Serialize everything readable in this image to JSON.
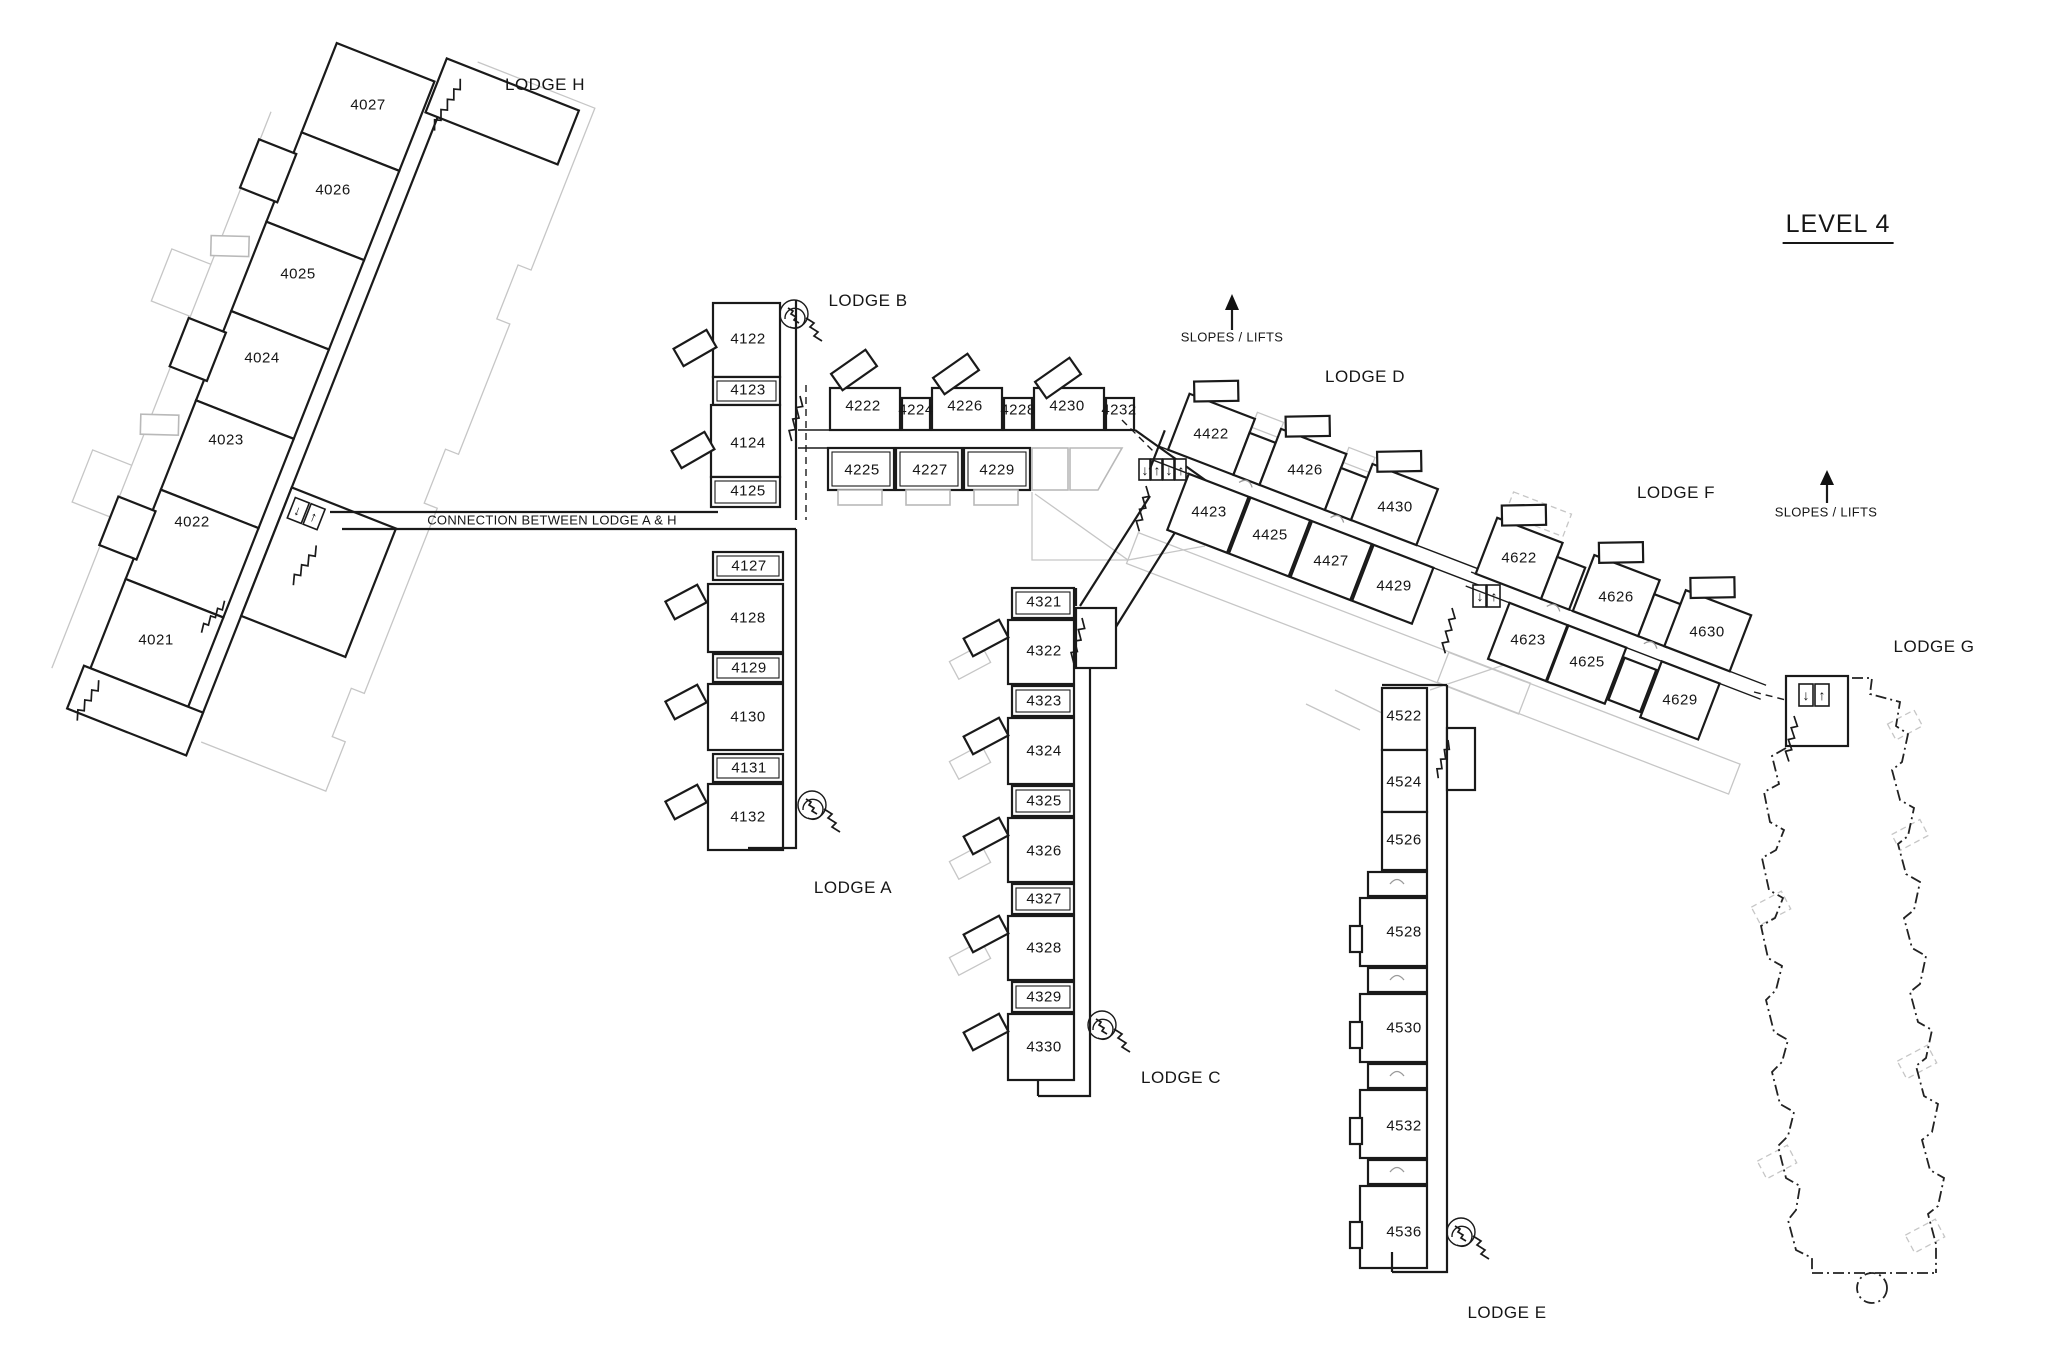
{
  "icons": {
    "elevator_down": "↓",
    "elevator_up": "↑"
  },
  "colors": {
    "wall": "#1a1a1a",
    "ghost": "#c6c6c6",
    "text": "#161616"
  },
  "place_labels": [
    {
      "id": "level-title",
      "text": "LEVEL 4",
      "x": 1838,
      "y": 227,
      "cls": "title"
    },
    {
      "id": "lodge-h-label",
      "text": "LODGE H",
      "x": 545,
      "y": 85,
      "cls": "lodge"
    },
    {
      "id": "lodge-b-label",
      "text": "LODGE B",
      "x": 868,
      "y": 301,
      "cls": "lodge"
    },
    {
      "id": "lodge-a-label",
      "text": "LODGE A",
      "x": 853,
      "y": 888,
      "cls": "lodge"
    },
    {
      "id": "lodge-c-label",
      "text": "LODGE C",
      "x": 1181,
      "y": 1078,
      "cls": "lodge"
    },
    {
      "id": "lodge-d-label",
      "text": "LODGE D",
      "x": 1365,
      "y": 377,
      "cls": "lodge"
    },
    {
      "id": "lodge-e-label",
      "text": "LODGE E",
      "x": 1507,
      "y": 1313,
      "cls": "lodge"
    },
    {
      "id": "lodge-f-label",
      "text": "LODGE F",
      "x": 1676,
      "y": 493,
      "cls": "lodge"
    },
    {
      "id": "lodge-g-label",
      "text": "LODGE G",
      "x": 1934,
      "y": 647,
      "cls": "lodge"
    },
    {
      "id": "connection-label",
      "text": "CONNECTION BETWEEN LODGE A & H",
      "x": 552,
      "y": 520,
      "cls": "small"
    },
    {
      "id": "slopes-lifts-1",
      "text": "SLOPES / LIFTS",
      "x": 1232,
      "y": 337,
      "cls": "small"
    },
    {
      "id": "slopes-lifts-2",
      "text": "SLOPES / LIFTS",
      "x": 1826,
      "y": 512,
      "cls": "small"
    }
  ],
  "rooms": [
    {
      "n": "4027",
      "x": 368,
      "y": 105
    },
    {
      "n": "4026",
      "x": 333,
      "y": 190
    },
    {
      "n": "4025",
      "x": 298,
      "y": 274
    },
    {
      "n": "4024",
      "x": 262,
      "y": 358
    },
    {
      "n": "4023",
      "x": 226,
      "y": 440
    },
    {
      "n": "4022",
      "x": 192,
      "y": 522
    },
    {
      "n": "4021",
      "x": 156,
      "y": 640
    },
    {
      "n": "4122",
      "x": 748,
      "y": 339
    },
    {
      "n": "4123",
      "x": 748,
      "y": 390
    },
    {
      "n": "4124",
      "x": 748,
      "y": 443
    },
    {
      "n": "4125",
      "x": 748,
      "y": 491
    },
    {
      "n": "4222",
      "x": 863,
      "y": 406
    },
    {
      "n": "4224",
      "x": 916,
      "y": 410
    },
    {
      "n": "4226",
      "x": 965,
      "y": 406
    },
    {
      "n": "4228",
      "x": 1018,
      "y": 410
    },
    {
      "n": "4230",
      "x": 1067,
      "y": 406
    },
    {
      "n": "4232",
      "x": 1119,
      "y": 410
    },
    {
      "n": "4225",
      "x": 862,
      "y": 470
    },
    {
      "n": "4227",
      "x": 930,
      "y": 470
    },
    {
      "n": "4229",
      "x": 997,
      "y": 470
    },
    {
      "n": "4127",
      "x": 749,
      "y": 566
    },
    {
      "n": "4128",
      "x": 748,
      "y": 618
    },
    {
      "n": "4129",
      "x": 749,
      "y": 668
    },
    {
      "n": "4130",
      "x": 748,
      "y": 717
    },
    {
      "n": "4131",
      "x": 749,
      "y": 768
    },
    {
      "n": "4132",
      "x": 748,
      "y": 817
    },
    {
      "n": "4321",
      "x": 1044,
      "y": 602
    },
    {
      "n": "4322",
      "x": 1044,
      "y": 651
    },
    {
      "n": "4323",
      "x": 1044,
      "y": 701
    },
    {
      "n": "4324",
      "x": 1044,
      "y": 751
    },
    {
      "n": "4325",
      "x": 1044,
      "y": 801
    },
    {
      "n": "4326",
      "x": 1044,
      "y": 851
    },
    {
      "n": "4327",
      "x": 1044,
      "y": 899
    },
    {
      "n": "4328",
      "x": 1044,
      "y": 948
    },
    {
      "n": "4329",
      "x": 1044,
      "y": 997
    },
    {
      "n": "4330",
      "x": 1044,
      "y": 1047
    },
    {
      "n": "4422",
      "x": 1211,
      "y": 434
    },
    {
      "n": "4426",
      "x": 1305,
      "y": 470
    },
    {
      "n": "4430",
      "x": 1395,
      "y": 507
    },
    {
      "n": "4423",
      "x": 1209,
      "y": 512
    },
    {
      "n": "4425",
      "x": 1270,
      "y": 535
    },
    {
      "n": "4427",
      "x": 1331,
      "y": 561
    },
    {
      "n": "4429",
      "x": 1394,
      "y": 586
    },
    {
      "n": "4622",
      "x": 1519,
      "y": 558
    },
    {
      "n": "4626",
      "x": 1616,
      "y": 597
    },
    {
      "n": "4630",
      "x": 1707,
      "y": 632
    },
    {
      "n": "4623",
      "x": 1528,
      "y": 640
    },
    {
      "n": "4625",
      "x": 1587,
      "y": 662
    },
    {
      "n": "4629",
      "x": 1680,
      "y": 700
    },
    {
      "n": "4522",
      "x": 1404,
      "y": 716
    },
    {
      "n": "4524",
      "x": 1404,
      "y": 782
    },
    {
      "n": "4526",
      "x": 1404,
      "y": 840
    },
    {
      "n": "4528",
      "x": 1404,
      "y": 932
    },
    {
      "n": "4530",
      "x": 1404,
      "y": 1028
    },
    {
      "n": "4532",
      "x": 1404,
      "y": 1126
    },
    {
      "n": "4536",
      "x": 1404,
      "y": 1232
    }
  ]
}
